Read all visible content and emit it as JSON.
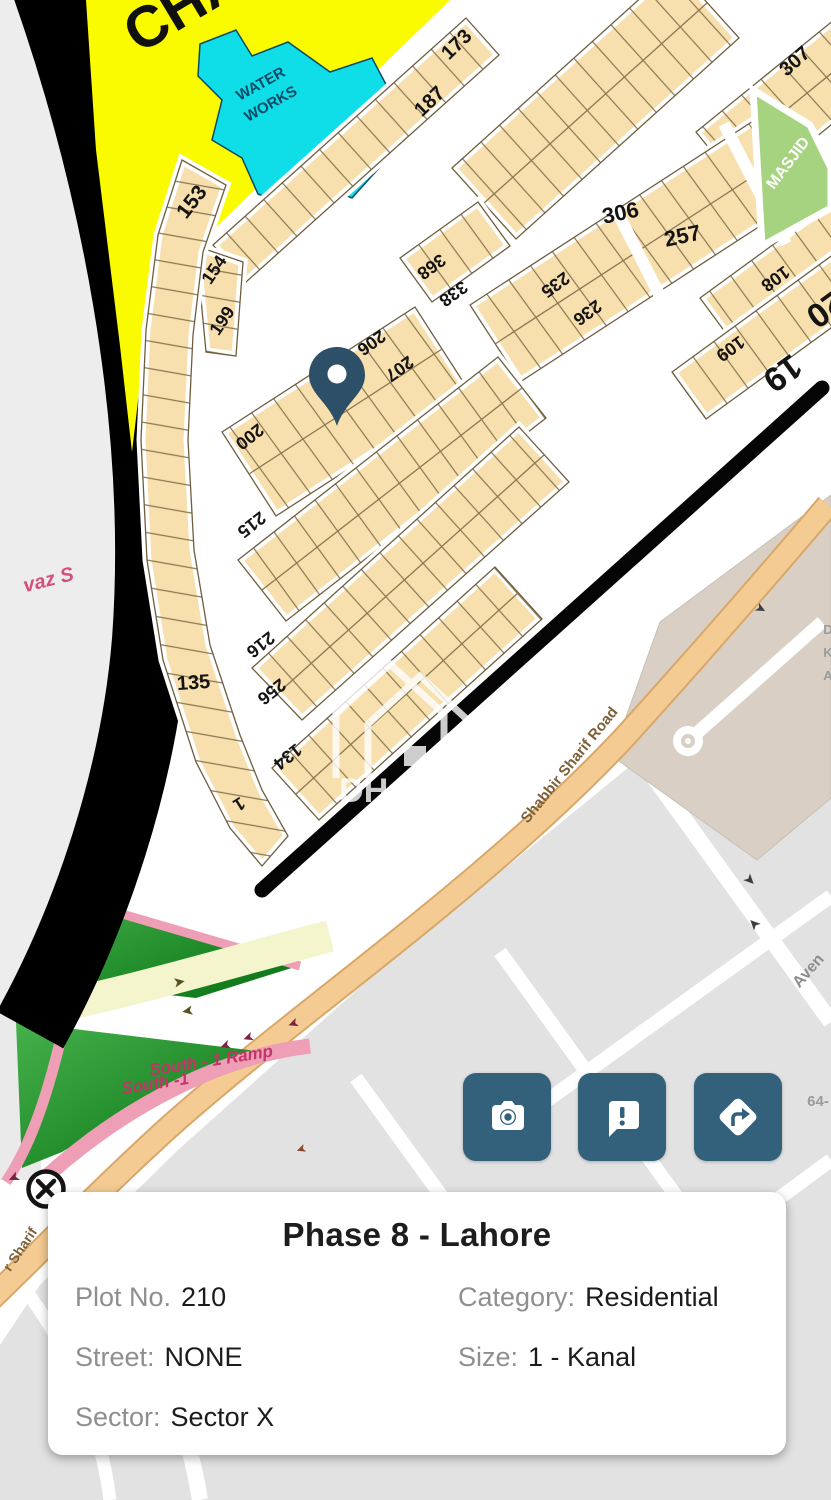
{
  "info_card": {
    "title": "Phase 8 - Lahore",
    "fields": {
      "plot": {
        "label": "Plot No.",
        "value": "210"
      },
      "category": {
        "label": "Category:",
        "value": "Residential"
      },
      "street": {
        "label": "Street:",
        "value": "NONE"
      },
      "size": {
        "label": "Size:",
        "value": "1 - Kanal"
      },
      "sector": {
        "label": "Sector:",
        "value": "Sector X"
      }
    }
  },
  "action_buttons": [
    {
      "icon": "camera-icon"
    },
    {
      "icon": "feedback-icon"
    },
    {
      "icon": "directions-icon"
    }
  ],
  "colors": {
    "accent": "#33617c",
    "marker": "#2d5068",
    "plot_fill": "#f7dfae",
    "plot_line": "#6f5e3e",
    "masjid": "#a6d380",
    "water": "#0fdde8",
    "open_land": "#fbfb00",
    "ramp_pink": "#ee9eb5",
    "green_dark": "#0b7a18"
  },
  "map": {
    "watermark": "DHA Plus",
    "labels": [
      {
        "t": "CHA",
        "x": 193,
        "y": 22,
        "r": -31,
        "s": 58,
        "c": "#101010"
      },
      {
        "t": "WATER",
        "x": 263,
        "y": 88,
        "r": -29,
        "s": 15,
        "c": "#0b4a66"
      },
      {
        "t": "WORKS",
        "x": 273,
        "y": 108,
        "r": -29,
        "s": 15,
        "c": "#0b4a66"
      },
      {
        "t": "153",
        "x": 197,
        "y": 206,
        "r": -52,
        "s": 21
      },
      {
        "t": "154",
        "x": 219,
        "y": 273,
        "r": -56,
        "s": 18
      },
      {
        "t": "199",
        "x": 227,
        "y": 324,
        "r": -56,
        "s": 18
      },
      {
        "t": "173",
        "x": 461,
        "y": 49,
        "r": -44,
        "s": 20
      },
      {
        "t": "187",
        "x": 434,
        "y": 106,
        "r": -44,
        "s": 20
      },
      {
        "t": "200",
        "x": 246,
        "y": 432,
        "r": 142,
        "s": 18
      },
      {
        "t": "206",
        "x": 368,
        "y": 338,
        "r": 144,
        "s": 18
      },
      {
        "t": "207",
        "x": 396,
        "y": 364,
        "r": 144,
        "s": 18
      },
      {
        "t": "368",
        "x": 428,
        "y": 262,
        "r": 144,
        "s": 18
      },
      {
        "t": "338",
        "x": 450,
        "y": 289,
        "r": 144,
        "s": 18
      },
      {
        "t": "306",
        "x": 622,
        "y": 220,
        "r": -12,
        "s": 22
      },
      {
        "t": "257",
        "x": 684,
        "y": 243,
        "r": -12,
        "s": 22
      },
      {
        "t": "307",
        "x": 799,
        "y": 66,
        "r": -42,
        "s": 20
      },
      {
        "t": "235",
        "x": 552,
        "y": 280,
        "r": 144,
        "s": 18
      },
      {
        "t": "236",
        "x": 584,
        "y": 308,
        "r": 144,
        "s": 18
      },
      {
        "t": "108",
        "x": 772,
        "y": 274,
        "r": 144,
        "s": 18
      },
      {
        "t": "20",
        "x": 819,
        "y": 300,
        "r": 144,
        "s": 34
      },
      {
        "t": "109",
        "x": 727,
        "y": 344,
        "r": 144,
        "s": 18
      },
      {
        "t": "19",
        "x": 776,
        "y": 364,
        "r": 144,
        "s": 34
      },
      {
        "t": "MASJID",
        "x": 792,
        "y": 166,
        "r": -53,
        "s": 16,
        "c": "#ffffff"
      },
      {
        "t": "215",
        "x": 248,
        "y": 520,
        "r": 142,
        "s": 18
      },
      {
        "t": "216",
        "x": 257,
        "y": 640,
        "r": 142,
        "s": 18
      },
      {
        "t": "256",
        "x": 268,
        "y": 687,
        "r": 142,
        "s": 18
      },
      {
        "t": "135",
        "x": 194,
        "y": 689,
        "r": -4,
        "s": 20
      },
      {
        "t": "134",
        "x": 284,
        "y": 752,
        "r": 142,
        "s": 18
      },
      {
        "t": "1",
        "x": 236,
        "y": 799,
        "r": 148,
        "s": 18
      },
      {
        "t": "vaz S",
        "x": 50,
        "y": 586,
        "r": -14,
        "s": 20,
        "c": "#d44f7e",
        "i": 1
      },
      {
        "t": "Shabbir Sharif Road",
        "x": 573,
        "y": 768,
        "r": -51,
        "s": 15,
        "c": "#7d6038",
        "w": 600
      },
      {
        "t": "r Sharif",
        "x": 24,
        "y": 1252,
        "r": -56,
        "s": 14,
        "c": "#7d6038",
        "w": 600
      },
      {
        "t": "South - 1 Ramp",
        "x": 212,
        "y": 1066,
        "r": -9,
        "s": 17,
        "c": "#c23568",
        "i": 1
      },
      {
        "t": "South -1",
        "x": 156,
        "y": 1089,
        "r": -9,
        "s": 17,
        "c": "#c23568",
        "i": 1
      },
      {
        "t": "Aven",
        "x": 812,
        "y": 974,
        "r": -49,
        "s": 16,
        "c": "#8d8d8d",
        "w": 600
      },
      {
        "t": "64-",
        "x": 818,
        "y": 1106,
        "r": 0,
        "s": 15,
        "c": "#9b9b9b",
        "w": 600
      },
      {
        "t": "D",
        "x": 828,
        "y": 634,
        "r": 0,
        "s": 13,
        "c": "#9b9b9b",
        "w": 600
      },
      {
        "t": "K",
        "x": 828,
        "y": 657,
        "r": 0,
        "s": 13,
        "c": "#9b9b9b",
        "w": 600
      },
      {
        "t": "A",
        "x": 828,
        "y": 680,
        "r": 0,
        "s": 13,
        "c": "#9b9b9b",
        "w": 600
      },
      {
        "t": "➤",
        "x": 747,
        "y": 883,
        "r": 45,
        "s": 13,
        "c": "#3d3d3d"
      },
      {
        "t": "➤",
        "x": 757,
        "y": 921,
        "r": -135,
        "s": 13,
        "c": "#3d3d3d"
      },
      {
        "t": "➤",
        "x": 759,
        "y": 612,
        "r": 28,
        "s": 12,
        "c": "#3d3d3d"
      },
      {
        "t": "➤",
        "x": 180,
        "y": 986,
        "r": -10,
        "s": 13,
        "c": "#55531f"
      },
      {
        "t": "➤",
        "x": 187,
        "y": 1007,
        "r": 170,
        "s": 13,
        "c": "#55531f"
      },
      {
        "t": "➤",
        "x": 224,
        "y": 1042,
        "r": 160,
        "s": 12,
        "c": "#7e2242"
      },
      {
        "t": "➤",
        "x": 247,
        "y": 1034,
        "r": 160,
        "s": 12,
        "c": "#7e2242"
      },
      {
        "t": "➤",
        "x": 292,
        "y": 1020,
        "r": 160,
        "s": 12,
        "c": "#7e2242"
      },
      {
        "t": "➤",
        "x": 12,
        "y": 1174,
        "r": 155,
        "s": 13,
        "c": "#7e2242"
      },
      {
        "t": "➤",
        "x": 300,
        "y": 1146,
        "r": 160,
        "s": 11,
        "c": "#8a4a2a"
      }
    ],
    "blocks": [
      {
        "pts": "213,245 466,18 499,55 246,282",
        "p": "p42"
      },
      {
        "pts": "196,246 243,262 236,356 206,352",
        "p": "ph"
      },
      {
        "pts": "182,160 158,235 146,330 141,440 147,560 163,660 196,762 230,828 262,866 288,836 262,790 240,735 210,645 194,550 188,440 193,335 203,252 226,185",
        "p": "ph"
      },
      {
        "pts": "452,168 675,-33 739,38 516,239",
        "p": "p42",
        "mid": "484,203 707,3"
      },
      {
        "pts": "696,132 856,2 906,64 746,194",
        "p": "p42",
        "mid": "721,163 881,33"
      },
      {
        "pts": "470,305 767,112 817,189 520,382",
        "p": "p36",
        "mid": "495,344 792,151"
      },
      {
        "pts": "400,258 478,202 510,246 432,302",
        "p": "p36"
      },
      {
        "pts": "222,432 415,307 469,391 276,516",
        "p": "p36",
        "mid": "249,474 442,349"
      },
      {
        "pts": "700,298 837,198 868,240 731,340",
        "p": "p36"
      },
      {
        "pts": "672,372 834,254 868,301 706,419",
        "p": "p36"
      },
      {
        "pts": "238,560 498,357 546,418 286,621",
        "p": "p36",
        "mid": "262,590 522,388"
      },
      {
        "pts": "252,668 519,427 569,482 302,720",
        "p": "p42",
        "mid": "277,694 544,455"
      },
      {
        "pts": "272,768 495,567 542,619 319,820",
        "p": "p42",
        "mid": "296,794 518,593"
      }
    ]
  }
}
